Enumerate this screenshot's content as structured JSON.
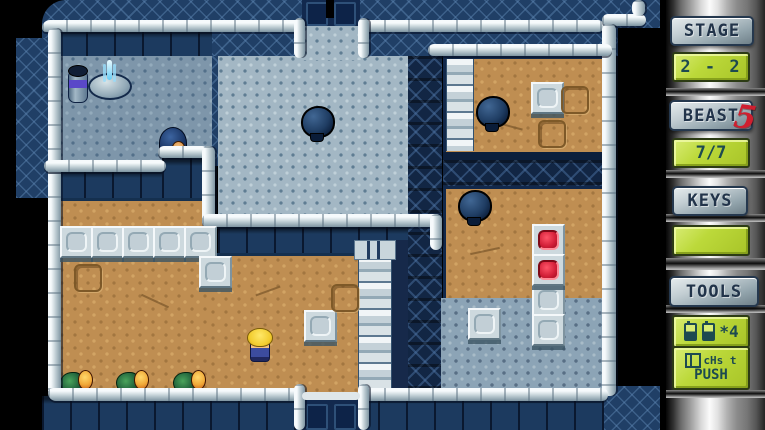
{
  "screen": {
    "width": 765,
    "height": 430
  },
  "hud": {
    "stage": {
      "label": "STAGE",
      "value": "2 - 2"
    },
    "beast": {
      "label": "BEAST",
      "value": "7/7",
      "mark": "5"
    },
    "keys": {
      "label": "KEYS",
      "value": ""
    },
    "tools": {
      "label": "TOOLS",
      "count_text": "*4",
      "icons_text": "cHs t",
      "action_text": "PUSH"
    }
  },
  "colors": {
    "lcd_green": "#b9d636",
    "lcd_text": "#1d4a50",
    "plaque_text": "#22344a",
    "beast_mark_red": "#cf1f2f",
    "wall_navy": "#203f66",
    "floor_brown": "#bf8e52"
  },
  "entities": {
    "player": [
      {
        "x": 246,
        "y": 328
      }
    ],
    "beast": [
      {
        "x": 299,
        "y": 104
      },
      {
        "x": 474,
        "y": 94
      },
      {
        "x": 456,
        "y": 188
      }
    ],
    "blue_creature": [
      {
        "x": 158,
        "y": 126
      }
    ],
    "green_creature": [
      {
        "x": 60,
        "y": 368
      },
      {
        "x": 116,
        "y": 368
      },
      {
        "x": 173,
        "y": 368
      }
    ],
    "block": [
      {
        "x": 60,
        "y": 226
      },
      {
        "x": 91,
        "y": 226
      },
      {
        "x": 122,
        "y": 226
      },
      {
        "x": 153,
        "y": 226
      },
      {
        "x": 184,
        "y": 226
      },
      {
        "x": 199,
        "y": 256
      },
      {
        "x": 304,
        "y": 310
      },
      {
        "x": 531,
        "y": 82
      },
      {
        "x": 468,
        "y": 308
      },
      {
        "x": 532,
        "y": 284
      },
      {
        "x": 532,
        "y": 314
      }
    ],
    "red_block": [
      {
        "x": 532,
        "y": 224
      },
      {
        "x": 532,
        "y": 254
      }
    ],
    "slot": [
      {
        "x": 561,
        "y": 86
      },
      {
        "x": 74,
        "y": 264
      },
      {
        "x": 331,
        "y": 284
      },
      {
        "x": 538,
        "y": 120
      }
    ],
    "barrel": [
      {
        "x": 66,
        "y": 62
      }
    ],
    "fountain": [
      {
        "x": 88,
        "y": 60
      }
    ]
  }
}
